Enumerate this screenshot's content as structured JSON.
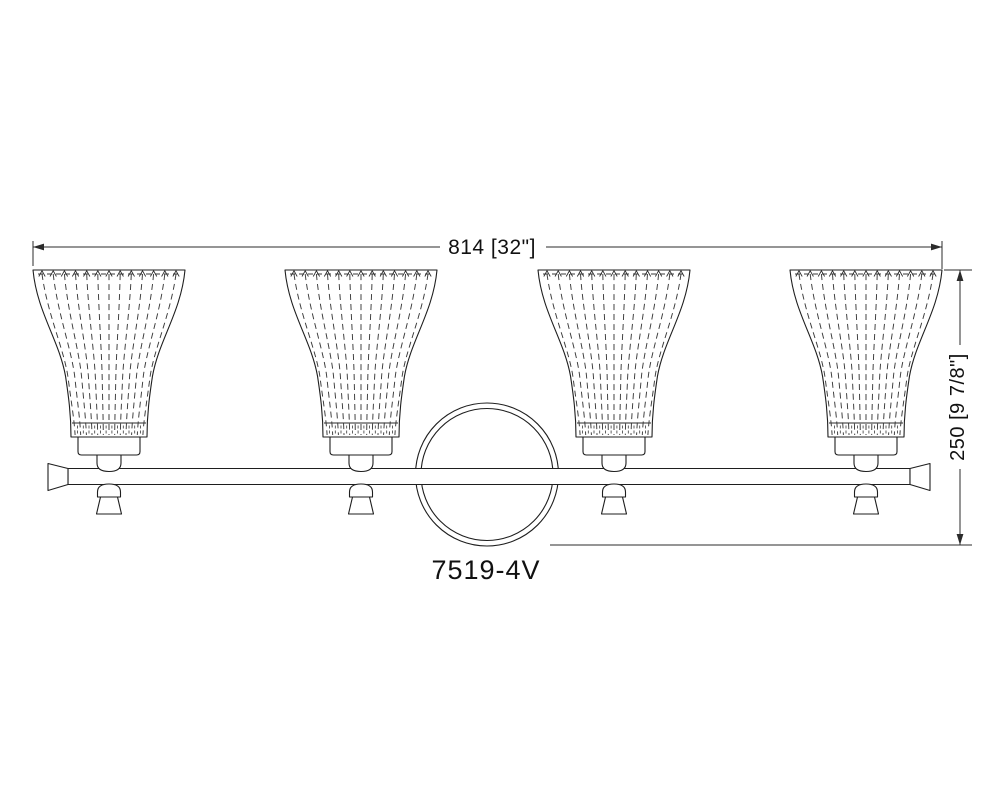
{
  "drawing": {
    "model_number": "7519-4V",
    "width_dimension_label": "814 [32\"]",
    "height_dimension_label": "250 [9 7/8\"]",
    "line_color": "#1e1e1e",
    "background_color": "#ffffff"
  }
}
